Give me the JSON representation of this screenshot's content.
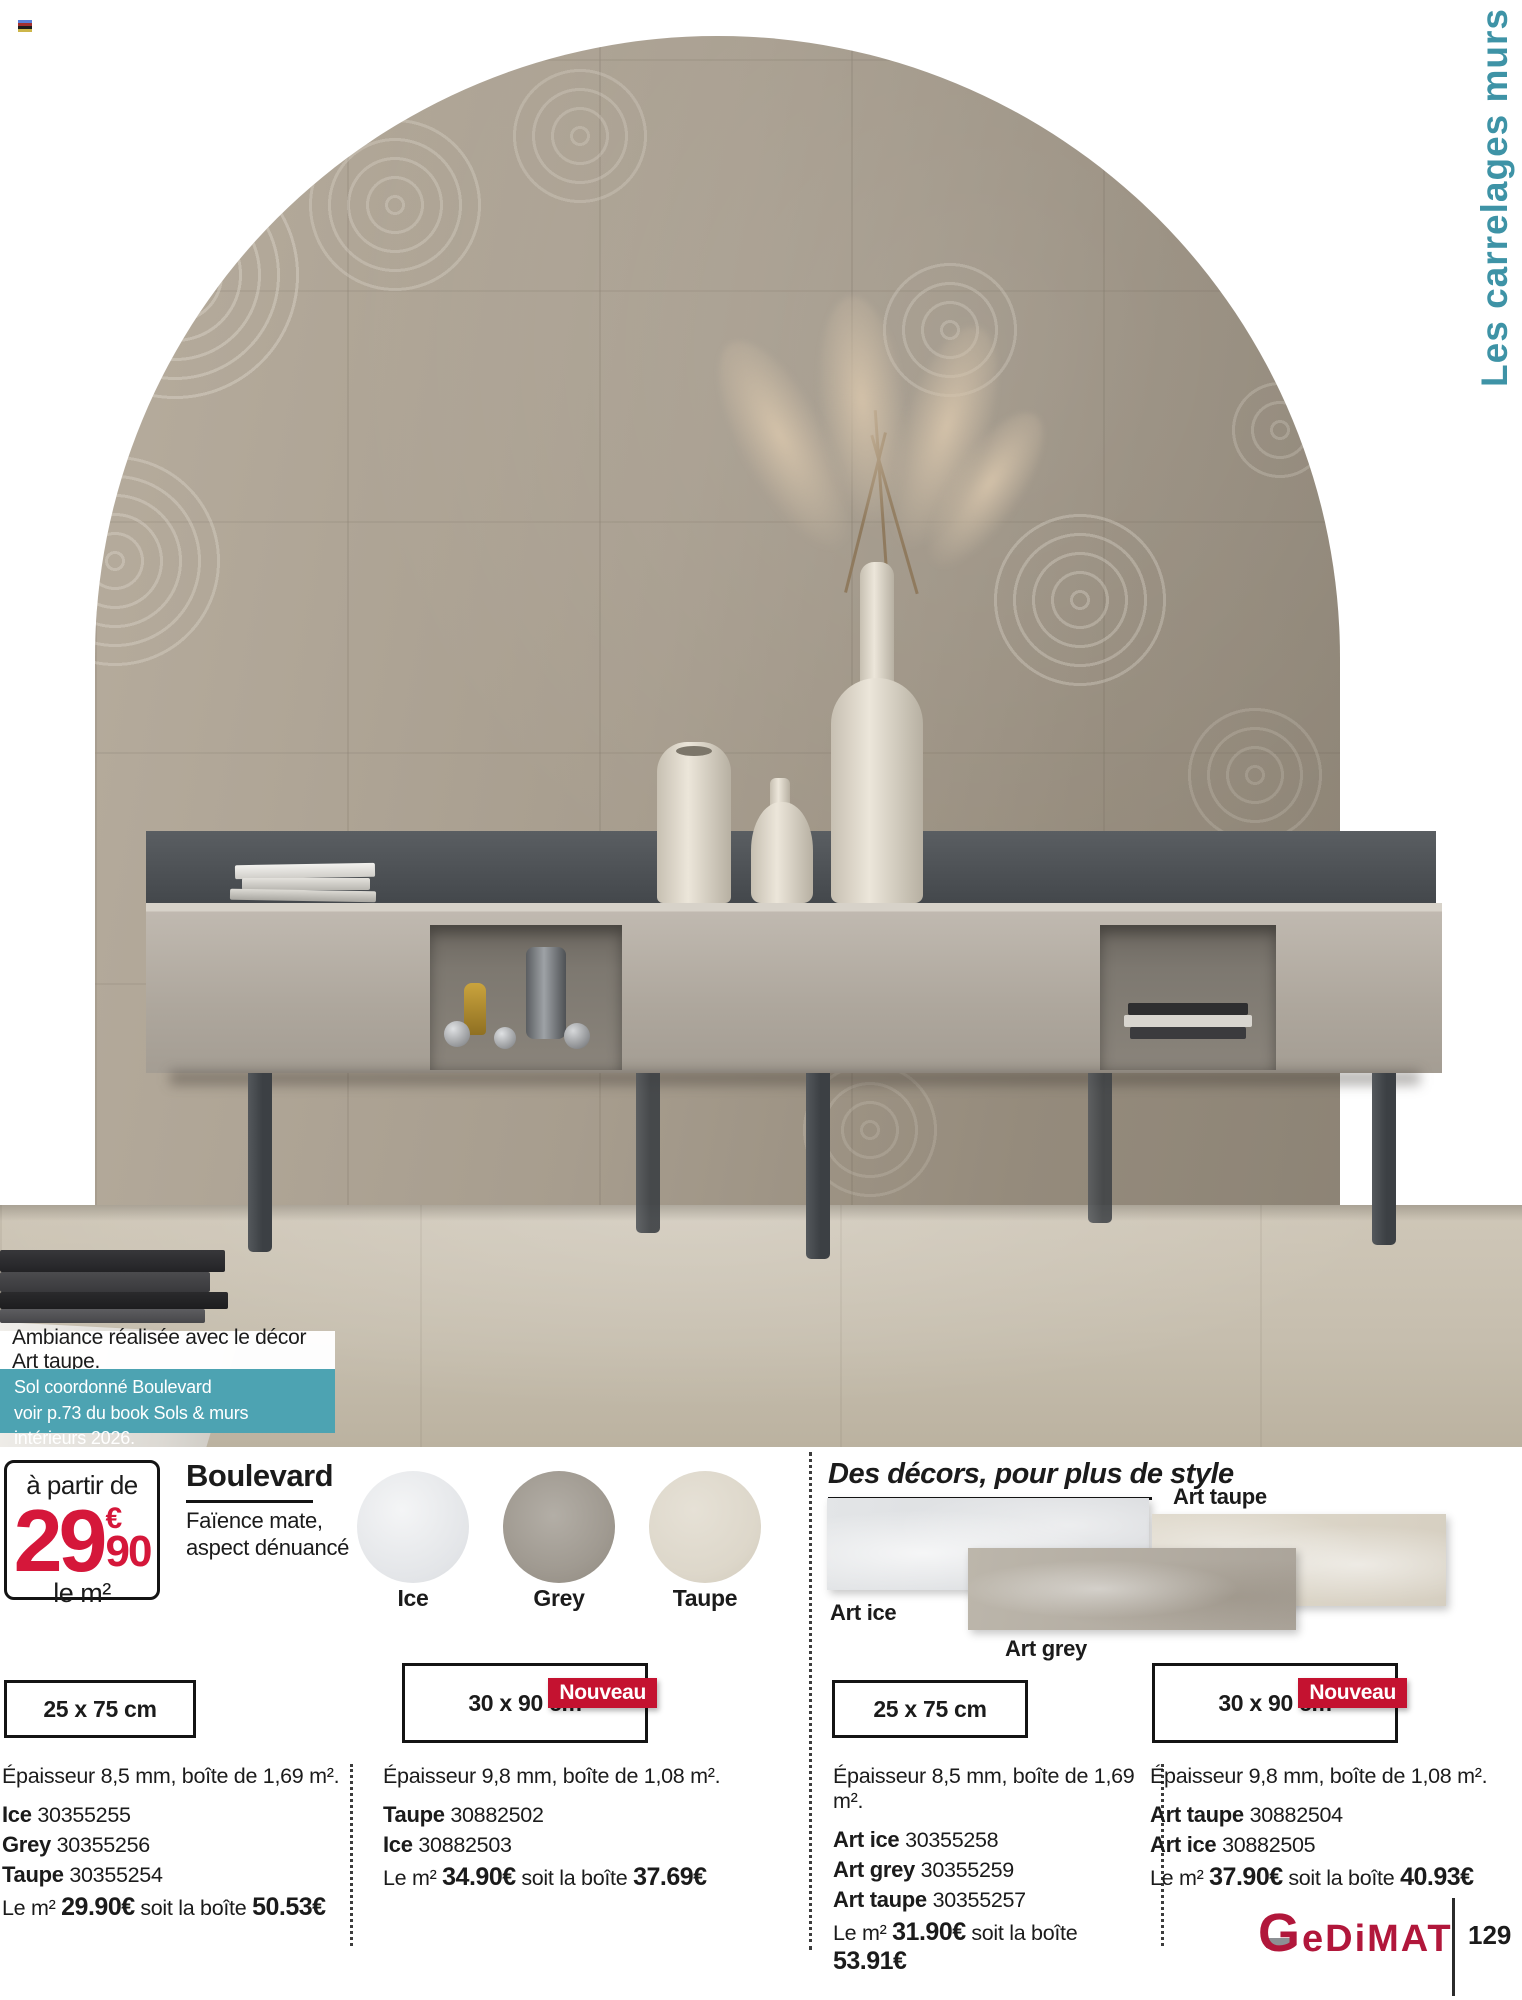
{
  "colors": {
    "teal": "#3e93a6",
    "teal_box": "#4da3b2",
    "red": "#d5173a",
    "brand_red": "#b1173b",
    "nouveau_bg": "#c41230"
  },
  "side_title": "Les carrelages murs",
  "photo": {
    "caption": "Ambiance réalisée avec le décor Art taupe.",
    "note_line1": "Sol coordonné Boulevard",
    "note_line2": "voir p.73 du book Sols & murs intérieurs 2026."
  },
  "price_badge": {
    "prefix": "à partir de",
    "amount": "29",
    "currency": "€",
    "cents": "90",
    "unit": "le m²"
  },
  "product": {
    "name": "Boulevard",
    "desc1": "Faïence mate,",
    "desc2": "aspect dénuancé"
  },
  "swatches": [
    {
      "label": "Ice"
    },
    {
      "label": "Grey"
    },
    {
      "label": "Taupe"
    }
  ],
  "decors": {
    "title": "Des décors, pour plus de style",
    "label_art_taupe": "Art taupe",
    "label_art_ice": "Art ice",
    "label_art_grey": "Art grey"
  },
  "nouveau": "Nouveau",
  "columns": [
    {
      "size": "25 x 75 cm",
      "thickness": "Épaisseur 8,5 mm, boîte de 1,69 m².",
      "refs": [
        {
          "name": "Ice",
          "sku": "30355255"
        },
        {
          "name": "Grey",
          "sku": "30355256"
        },
        {
          "name": "Taupe",
          "sku": "30355254"
        }
      ],
      "m2_label": "Le m²",
      "m2_price": "29.90€",
      "box_label": "soit la boîte",
      "box_price": "50.53€"
    },
    {
      "size": "30 x 90 cm",
      "thickness": "Épaisseur 9,8 mm, boîte de 1,08 m².",
      "refs": [
        {
          "name": "Taupe",
          "sku": "30882502"
        },
        {
          "name": "Ice",
          "sku": "30882503"
        }
      ],
      "m2_label": "Le m²",
      "m2_price": "34.90€",
      "box_label": "soit la boîte",
      "box_price": "37.69€"
    },
    {
      "size": "25 x 75 cm",
      "thickness": "Épaisseur 8,5 mm, boîte de 1,69 m².",
      "refs": [
        {
          "name": "Art ice",
          "sku": "30355258"
        },
        {
          "name": "Art grey",
          "sku": "30355259"
        },
        {
          "name": "Art taupe",
          "sku": "30355257"
        }
      ],
      "m2_label": "Le m²",
      "m2_price": "31.90€",
      "box_label": "soit la boîte",
      "box_price": "53.91€"
    },
    {
      "size": "30 x 90 cm",
      "thickness": "Épaisseur 9,8 mm, boîte de 1,08 m².",
      "refs": [
        {
          "name": "Art taupe",
          "sku": "30882504"
        },
        {
          "name": "Art ice",
          "sku": "30882505"
        }
      ],
      "m2_label": "Le m²",
      "m2_price": "37.90€",
      "box_label": "soit la boîte",
      "box_price": "40.93€"
    }
  ],
  "footer": {
    "brand": "GeDiMAT",
    "page_number": "129"
  }
}
